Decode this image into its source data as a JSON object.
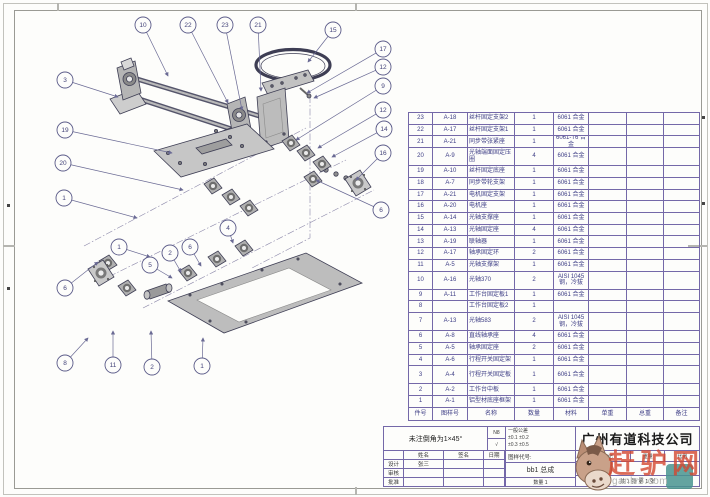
{
  "company": "广州有道科技公司",
  "title_block": {
    "note": "未注倒角为1×45°",
    "finish_top": "N8",
    "finish_bottom": "√",
    "tolerance_title": "一般公差",
    "tolerance_line1": "±0.1  ±0.2",
    "tolerance_line2": "±0.3  ±0.5",
    "sign_headers": [
      "",
      "姓名",
      "签名",
      "日期"
    ],
    "sign_rows": [
      [
        "设计",
        "张三",
        "",
        ""
      ],
      [
        "审核",
        "",
        "",
        ""
      ],
      [
        "批准",
        "",
        "",
        ""
      ]
    ],
    "code_label": "图样代号:",
    "drawing_name": "bb1 总成",
    "qty_note": "数量 1",
    "stage_label": "阶段标记",
    "weight_label": "重量",
    "scale_label": "比例",
    "sheet_note": "共 1 张  第 1 张"
  },
  "bom": {
    "headers": [
      "件号",
      "图样号",
      "名称",
      "数量",
      "材料",
      "单重",
      "总重",
      "备注"
    ],
    "rows": [
      {
        "item": "23",
        "code": "A-18",
        "name": "丝杆固定支架2",
        "qty": "1",
        "material": "6061 合金",
        "tall": false
      },
      {
        "item": "22",
        "code": "A-17",
        "name": "丝杆固定支架1",
        "qty": "1",
        "material": "6061 合金",
        "tall": false
      },
      {
        "item": "21",
        "code": "A-21",
        "name": "同步带张紧座",
        "qty": "1",
        "material": "6061-T6 合金",
        "tall": false
      },
      {
        "item": "20",
        "code": "A-9",
        "name": "光轴端面固定压圈",
        "qty": "4",
        "material": "6061 合金",
        "tall": true
      },
      {
        "item": "19",
        "code": "A-10",
        "name": "丝杆固定底座",
        "qty": "1",
        "material": "6061 合金",
        "tall": false
      },
      {
        "item": "18",
        "code": "A-7",
        "name": "同步带轮支架",
        "qty": "1",
        "material": "6061 合金",
        "tall": false
      },
      {
        "item": "17",
        "code": "A-21",
        "name": "电机固定支架",
        "qty": "1",
        "material": "6061 合金",
        "tall": false
      },
      {
        "item": "16",
        "code": "A-20",
        "name": "电机座",
        "qty": "1",
        "material": "6061 合金",
        "tall": false
      },
      {
        "item": "15",
        "code": "A-14",
        "name": "光轴支撑座",
        "qty": "1",
        "material": "6061 合金",
        "tall": false
      },
      {
        "item": "14",
        "code": "A-13",
        "name": "光轴固定座",
        "qty": "4",
        "material": "6061 合金",
        "tall": false
      },
      {
        "item": "13",
        "code": "A-19",
        "name": "联轴器",
        "qty": "1",
        "material": "6061 合金",
        "tall": false
      },
      {
        "item": "12",
        "code": "A-17",
        "name": "轴承固定环",
        "qty": "2",
        "material": "6061 合金",
        "tall": false
      },
      {
        "item": "11",
        "code": "A-5",
        "name": "光轴支撑架",
        "qty": "1",
        "material": "6061 合金",
        "tall": false
      },
      {
        "item": "10",
        "code": "A-16",
        "name": "光轴370",
        "qty": "2",
        "material": "AISI 1045 钢，冷拔",
        "tall": true
      },
      {
        "item": "9",
        "code": "A-11",
        "name": "工作台固定板1",
        "qty": "1",
        "material": "6061 合金",
        "tall": false
      },
      {
        "item": "8",
        "code": "",
        "name": "工作台固定板2",
        "qty": "1",
        "material": "",
        "tall": false
      },
      {
        "item": "7",
        "code": "A-13",
        "name": "光轴583",
        "qty": "2",
        "material": "AISI 1045 钢，冷拔",
        "tall": true
      },
      {
        "item": "6",
        "code": "A-8",
        "name": "直线轴承座",
        "qty": "4",
        "material": "6061 合金",
        "tall": false
      },
      {
        "item": "5",
        "code": "A-5",
        "name": "轴承固定座",
        "qty": "2",
        "material": "6061 合金",
        "tall": false
      },
      {
        "item": "4",
        "code": "A-6",
        "name": "行程开关固定架",
        "qty": "1",
        "material": "6061 合金",
        "tall": false
      },
      {
        "item": "3",
        "code": "A-4",
        "name": "行程开关固定板",
        "qty": "1",
        "material": "6061 合金",
        "tall": true
      },
      {
        "item": "2",
        "code": "A-2",
        "name": "工作台中板",
        "qty": "1",
        "material": "6061 合金",
        "tall": false
      },
      {
        "item": "1",
        "code": "A-1",
        "name": "铝型材底座框架",
        "qty": "1",
        "material": "6061 合金",
        "tall": false
      }
    ]
  },
  "balloons": [
    {
      "n": "10",
      "x": 143,
      "y": 25,
      "tx": 168,
      "ty": 76
    },
    {
      "n": "22",
      "x": 188,
      "y": 25,
      "tx": 228,
      "ty": 103
    },
    {
      "n": "23",
      "x": 225,
      "y": 25,
      "tx": 242,
      "ty": 110
    },
    {
      "n": "21",
      "x": 258,
      "y": 25,
      "tx": 261,
      "ty": 91
    },
    {
      "n": "15",
      "x": 333,
      "y": 30,
      "tx": 308,
      "ty": 62
    },
    {
      "n": "17",
      "x": 383,
      "y": 49,
      "tx": 307,
      "ty": 93
    },
    {
      "n": "12",
      "x": 383,
      "y": 67,
      "tx": 314,
      "ty": 98
    },
    {
      "n": "9",
      "x": 383,
      "y": 86,
      "tx": 296,
      "ty": 140
    },
    {
      "n": "12",
      "x": 383,
      "y": 110,
      "tx": 318,
      "ty": 148
    },
    {
      "n": "14",
      "x": 384,
      "y": 129,
      "tx": 332,
      "ty": 157
    },
    {
      "n": "16",
      "x": 383,
      "y": 153,
      "tx": 356,
      "ty": 180
    },
    {
      "n": "6",
      "x": 381,
      "y": 210,
      "tx": 316,
      "ty": 180
    },
    {
      "n": "3",
      "x": 65,
      "y": 80,
      "tx": 118,
      "ty": 97
    },
    {
      "n": "19",
      "x": 65,
      "y": 130,
      "tx": 172,
      "ty": 153
    },
    {
      "n": "20",
      "x": 63,
      "y": 163,
      "tx": 183,
      "ty": 190
    },
    {
      "n": "1",
      "x": 64,
      "y": 198,
      "tx": 137,
      "ty": 218
    },
    {
      "n": "6",
      "x": 65,
      "y": 288,
      "tx": 98,
      "ty": 262
    },
    {
      "n": "1",
      "x": 119,
      "y": 247,
      "tx": 150,
      "ty": 257
    },
    {
      "n": "2",
      "x": 170,
      "y": 253,
      "tx": 181,
      "ty": 272
    },
    {
      "n": "5",
      "x": 150,
      "y": 265,
      "tx": 172,
      "ty": 278
    },
    {
      "n": "6",
      "x": 190,
      "y": 247,
      "tx": 201,
      "ty": 266
    },
    {
      "n": "4",
      "x": 228,
      "y": 228,
      "tx": 233,
      "ty": 243
    },
    {
      "n": "8",
      "x": 65,
      "y": 363,
      "tx": 88,
      "ty": 338
    },
    {
      "n": "11",
      "x": 113,
      "y": 365,
      "tx": 113,
      "ty": 331
    },
    {
      "n": "2",
      "x": 152,
      "y": 367,
      "tx": 151,
      "ty": 331
    },
    {
      "n": "1",
      "x": 202,
      "y": 366,
      "tx": 203,
      "ty": 338
    }
  ],
  "watermark": {
    "brand": "赶驴网",
    "url": "ganlv5.com"
  }
}
